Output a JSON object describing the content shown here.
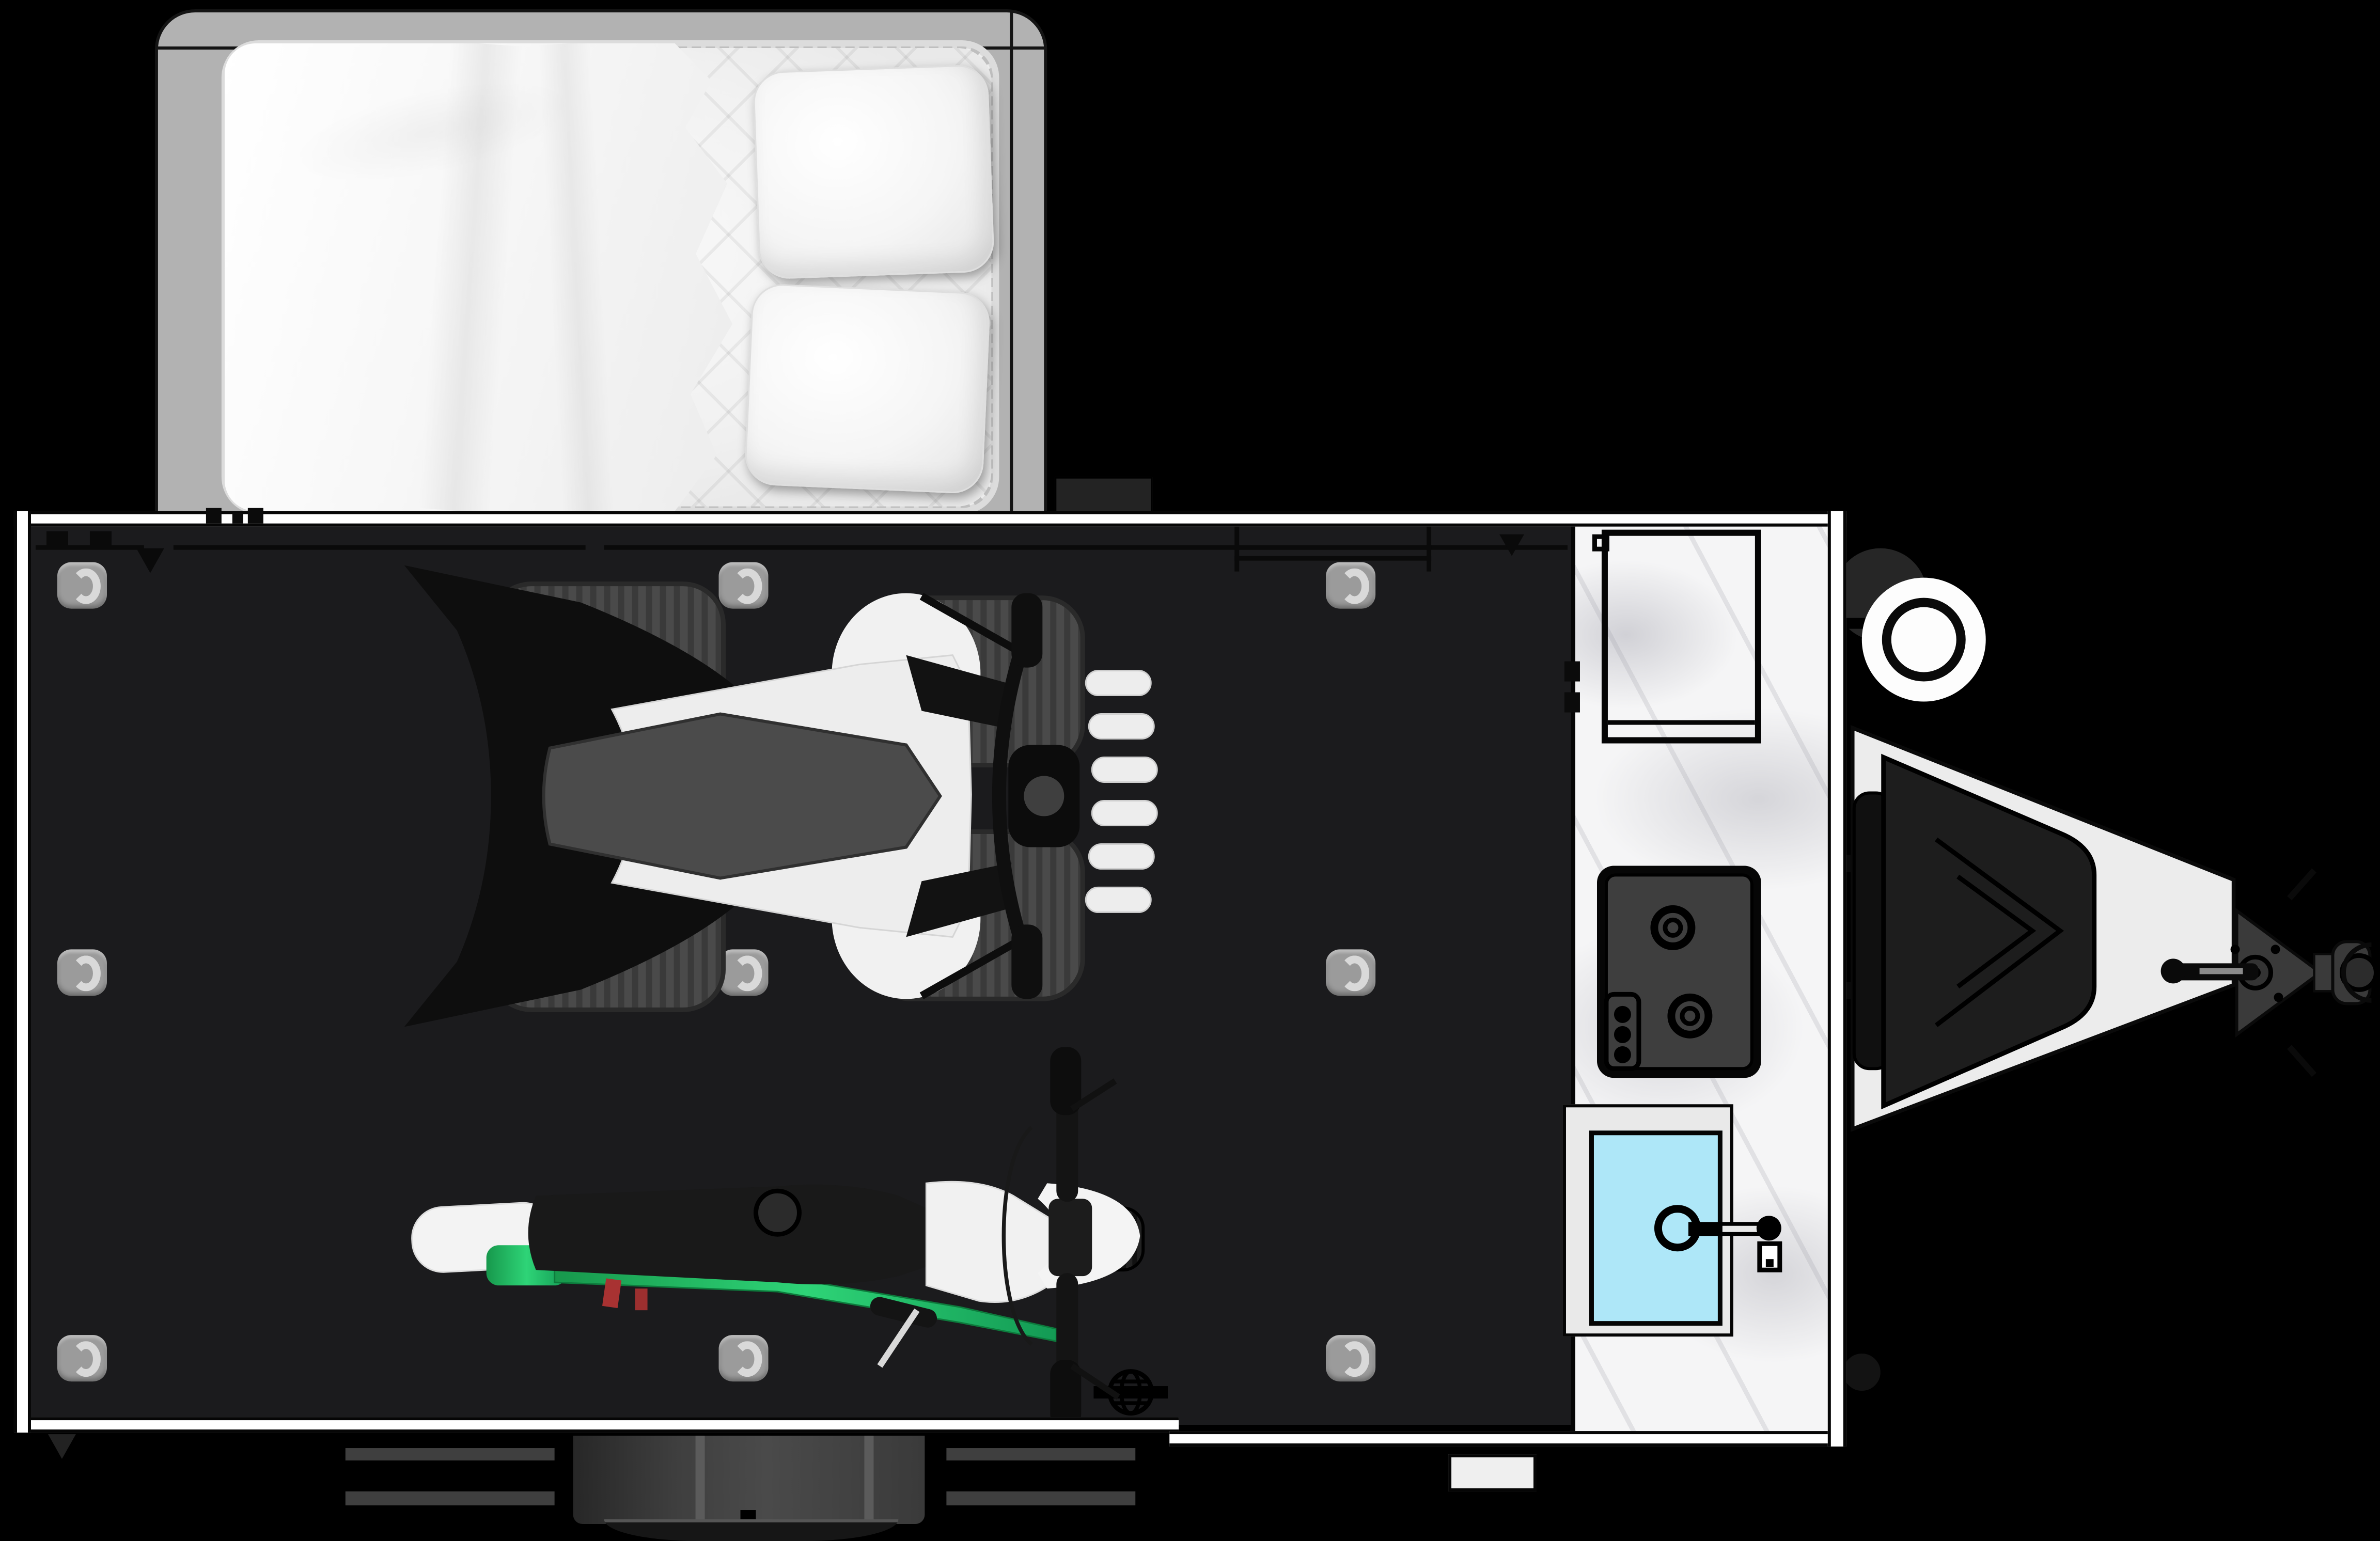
{
  "scene": {
    "kind": "toy-hauler-travel-trailer-floorplan-top-view",
    "background": "#000000"
  },
  "palette": {
    "wall": "#ffffff",
    "outline": "#0a0a0a",
    "floor": "#1b1b1d",
    "bed_platform": "#b2b2b2",
    "mattress": "#f2f2f2",
    "pillow": "#fafafa",
    "blanket": "#fbfbfb",
    "tire": "#4a4a4a",
    "atv_wing": "#0e0e0e",
    "atv_body": "#ededed",
    "atv_seat": "#4b4b4b",
    "bike_seat": "#191919",
    "bike_green": "#1cae58",
    "bike_red": "#a83232",
    "bike_body": "#f1f1f1",
    "marble": "#f5f5f6",
    "cooktop_surface": "#3e3e3e",
    "cooktop_frame": "#060606",
    "sink_deck": "#e9e9e9",
    "sink_basin": "#aee7f8",
    "tongue": "#ececec",
    "tongue_gear": "#3a3a3a",
    "step": "#3a3a3a",
    "d_ring_pad": "#9b9b9b",
    "d_ring": "#d9d9d9",
    "propane": "#fdfdfd"
  },
  "objects": {
    "bed": {
      "label": "Bed with blanket and two pillows"
    },
    "bed_platform": {
      "label": "Fold-out tent bed platform"
    },
    "blanket": {
      "label": "Blanket"
    },
    "pillow_top": {
      "label": "Pillow"
    },
    "pillow_bottom": {
      "label": "Pillow"
    },
    "garage_floor": {
      "label": "Garage cargo floor"
    },
    "atv": {
      "label": "ATV quad (top view)"
    },
    "dirt_bike": {
      "label": "Dirt bike (top view)"
    },
    "tie_down": {
      "label": "Floor tie-down D-ring"
    },
    "counter": {
      "label": "Marble kitchen counter"
    },
    "overhead_cabinet": {
      "label": "Overhead cabinet"
    },
    "cooktop": {
      "label": "Two-burner cooktop with control knobs"
    },
    "sink": {
      "label": "Kitchen sink with faucet"
    },
    "propane": {
      "label": "Propane tank"
    },
    "tongue": {
      "label": "A-frame trailer tongue"
    },
    "storage_box": {
      "label": "Tongue storage box"
    },
    "jack": {
      "label": "Tongue jack with crank handle"
    },
    "coupler": {
      "label": "Hitch coupler"
    },
    "safety_chain": {
      "label": "Safety chain"
    },
    "ramp_wall": {
      "label": "Rear ramp door wall"
    },
    "front_wall": {
      "label": "Front wall"
    },
    "side_wall": {
      "label": "Side wall"
    },
    "entry_step": {
      "label": "Slide-out entry step"
    },
    "stabilizer": {
      "label": "Stabilizer jack bar"
    },
    "fold_rack": {
      "label": "Wall-mounted fold-down rack"
    },
    "utility_port": {
      "label": "Exterior utility port"
    },
    "wheel": {
      "label": "Trailer wheel"
    },
    "jack_foot": {
      "label": "Rear stabilizer foot"
    }
  }
}
